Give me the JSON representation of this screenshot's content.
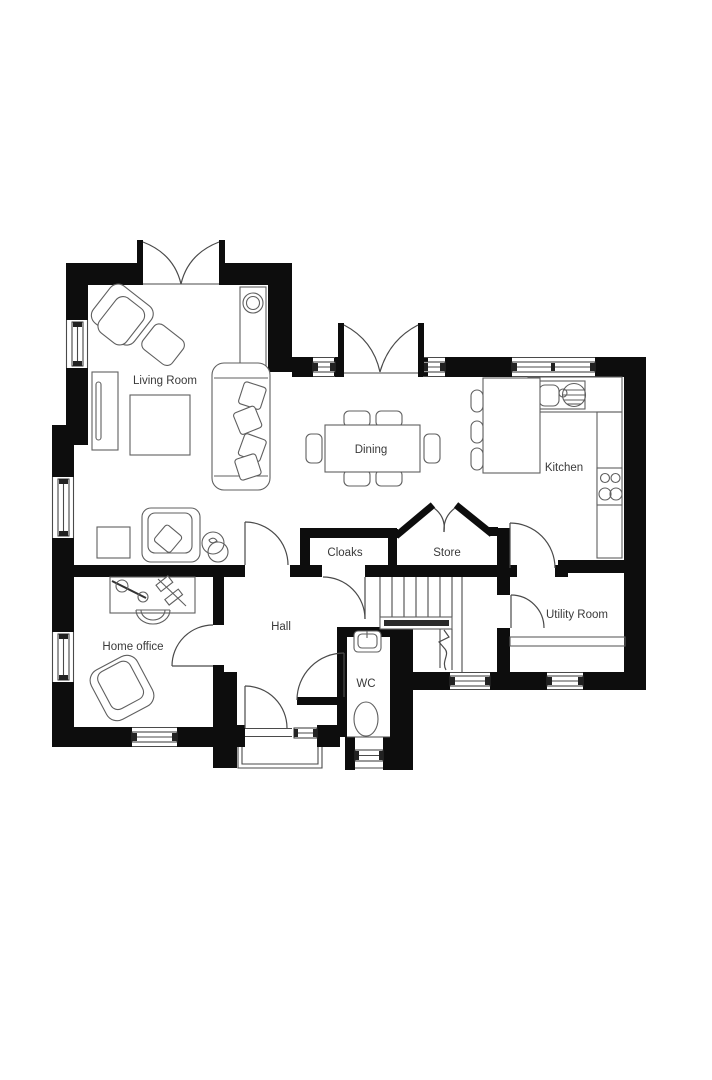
{
  "plan": {
    "type": "ground-floor-plan",
    "rooms": {
      "living_room": {
        "label": "Living Room"
      },
      "dining": {
        "label": "Dining"
      },
      "kitchen": {
        "label": "Kitchen"
      },
      "cloaks": {
        "label": "Cloaks"
      },
      "store": {
        "label": "Store"
      },
      "hall": {
        "label": "Hall"
      },
      "home_office": {
        "label": "Home office"
      },
      "wc": {
        "label": "WC"
      },
      "utility": {
        "label": "Utility Room"
      }
    },
    "colors": {
      "wall": "#0d0d0d",
      "line": "#4a4a4a",
      "label": "#3a3a3a",
      "background": "#ffffff"
    }
  }
}
